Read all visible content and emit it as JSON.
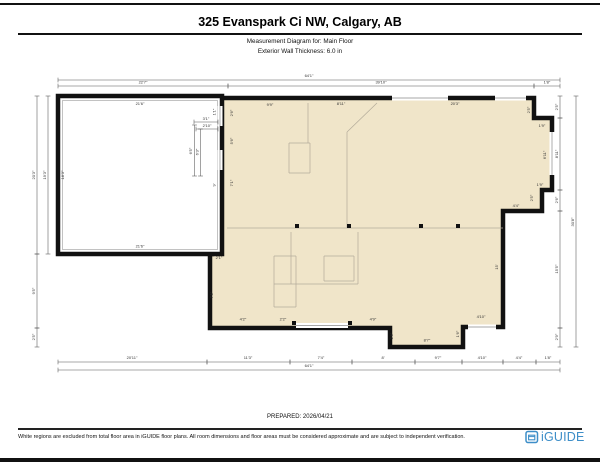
{
  "header": {
    "title": "325 Evanspark Ci NW, Calgary, AB",
    "subtitle1": "Measurement Diagram for: Main Floor",
    "subtitle2": "Exterior Wall Thickness: 6.0 in"
  },
  "footer": {
    "prepared": "PREPARED: 2026/04/21",
    "disclaimer": "White regions are excluded from total floor area in iGUIDE floor plans. All room dimensions and floor areas must be considered approximate and are subject to independent verification.",
    "logo_text": "iGUIDE"
  },
  "colors": {
    "floor_fill": "#f0e5c9",
    "wall": "#111111",
    "dim_line": "#555555",
    "dim_text": "#333333",
    "interior_line": "#b3ab9a",
    "opening_line": "#8a8a8a",
    "logo_blue": "#3d8ec8"
  },
  "floorplan": {
    "main_outline": "212,98 534,98 534,118 552,118 552,190 542,190 542,211 503,211 503,327 463,327 463,347 390,347 390,328 210,328 210,254 212,254",
    "garage": {
      "x": 58,
      "y": 96,
      "w": 164,
      "h": 158
    },
    "garage_inner": {
      "x": 62.5,
      "y": 100.5,
      "w": 155,
      "h": 149
    },
    "dim_lines": [
      [
        58,
        80,
        560,
        80
      ],
      [
        58,
        86,
        228,
        86
      ],
      [
        228,
        86,
        534,
        86
      ],
      [
        534,
        86,
        560,
        86
      ],
      [
        58,
        362,
        207,
        362
      ],
      [
        207,
        362,
        290,
        362
      ],
      [
        290,
        362,
        352,
        362
      ],
      [
        352,
        362,
        415,
        362
      ],
      [
        415,
        362,
        462,
        362
      ],
      [
        462,
        362,
        503,
        362
      ],
      [
        503,
        362,
        536,
        362
      ],
      [
        536,
        362,
        560,
        362
      ],
      [
        58,
        370,
        560,
        370
      ],
      [
        37,
        96,
        37,
        254
      ],
      [
        37,
        254,
        37,
        328
      ],
      [
        37,
        328,
        37,
        347
      ],
      [
        48,
        96,
        48,
        254
      ],
      [
        560,
        96,
        560,
        118
      ],
      [
        560,
        118,
        560,
        190
      ],
      [
        560,
        190,
        560,
        211
      ],
      [
        560,
        211,
        560,
        328
      ],
      [
        560,
        328,
        560,
        347
      ],
      [
        576,
        96,
        576,
        347
      ],
      [
        194,
        122,
        218,
        122
      ],
      [
        196,
        129,
        218,
        129
      ],
      [
        194.5,
        125,
        194.5,
        176
      ],
      [
        200.5,
        129,
        200.5,
        176
      ]
    ],
    "labels": [
      [
        "64'1\"",
        309,
        77,
        0
      ],
      [
        "22'7\"",
        143,
        83.5,
        0
      ],
      [
        "39'10\"",
        381,
        83.5,
        0
      ],
      [
        "1'8\"",
        547,
        83.5,
        0
      ],
      [
        "20'11\"",
        132,
        359,
        0
      ],
      [
        "11'3\"",
        248,
        359,
        0
      ],
      [
        "7'4\"",
        321,
        359,
        0
      ],
      [
        "8'",
        383,
        359,
        0
      ],
      [
        "9'7\"",
        438,
        359,
        0
      ],
      [
        "4'10\"",
        482,
        359,
        0
      ],
      [
        "4'4\"",
        519,
        359,
        0
      ],
      [
        "1'8\"",
        548,
        359,
        0
      ],
      [
        "64'1\"",
        309,
        367,
        0
      ],
      [
        "20'3\"",
        35,
        175,
        1
      ],
      [
        "9'5\"",
        35,
        291,
        1
      ],
      [
        "2'5\"",
        35,
        337,
        1
      ],
      [
        "19'3\"",
        46,
        175,
        1
      ],
      [
        "2'5\"",
        558,
        107,
        1
      ],
      [
        "8'11\"",
        558,
        154,
        1
      ],
      [
        "2'6\"",
        558,
        200,
        1
      ],
      [
        "15'5\"",
        558,
        269,
        1
      ],
      [
        "2'9\"",
        558,
        337,
        1
      ],
      [
        "30'8\"",
        574,
        222,
        1
      ],
      [
        "21'6\"",
        140,
        105,
        0
      ],
      [
        "21'6\"",
        140,
        247.5,
        0
      ],
      [
        "18'3\"",
        64,
        175,
        1
      ],
      [
        "3'1\"",
        206,
        120,
        0
      ],
      [
        "2'10\"",
        207,
        127,
        0
      ],
      [
        "6'5\"",
        192,
        151,
        1
      ],
      [
        "6'3\"",
        198.5,
        152,
        1
      ],
      [
        "1'1\"",
        215.5,
        112,
        1
      ],
      [
        "9'",
        215.5,
        185,
        1
      ],
      [
        "9'9\"",
        270,
        106,
        0
      ],
      [
        "8'11\"",
        341,
        105,
        0
      ],
      [
        "20'3\"",
        455,
        105,
        0
      ],
      [
        "2'5\"",
        530,
        110,
        1
      ],
      [
        "1'9\"",
        542,
        127,
        0
      ],
      [
        "6'11\"",
        546,
        155,
        1
      ],
      [
        "1'9\"",
        540,
        186,
        0
      ],
      [
        "2'5\"",
        533,
        198,
        1
      ],
      [
        "4'4\"",
        516,
        207,
        0
      ],
      [
        "15'",
        498,
        267,
        1
      ],
      [
        "4'10\"",
        481,
        318,
        0
      ],
      [
        "1'6\"",
        459,
        334,
        1
      ],
      [
        "8'7\"",
        427,
        341.5,
        0
      ],
      [
        "2'6\"",
        393,
        336,
        1
      ],
      [
        "4'9\"",
        373,
        320.5,
        0
      ],
      [
        "2'2\"",
        283,
        320.5,
        0
      ],
      [
        "4'2\"",
        243,
        320.5,
        0
      ],
      [
        "2'6\"",
        233,
        113,
        1
      ],
      [
        "5'6\"",
        233,
        141,
        1
      ],
      [
        "7'1\"",
        233,
        183,
        1
      ],
      [
        "2'1\"",
        219,
        259,
        0
      ],
      [
        "7'5\"",
        213,
        295,
        1
      ]
    ],
    "interior_lines": [
      [
        227,
        228,
        503,
        228
      ],
      [
        347,
        132,
        347,
        228
      ],
      [
        347,
        132,
        377,
        103
      ],
      [
        308,
        103,
        308,
        143
      ],
      [
        289,
        143,
        310,
        143
      ],
      [
        289,
        143,
        289,
        173
      ],
      [
        289,
        173,
        310,
        173
      ],
      [
        310,
        143,
        310,
        173
      ],
      [
        291,
        232,
        291,
        284
      ],
      [
        358,
        232,
        358,
        284
      ],
      [
        274,
        284,
        358,
        284
      ],
      [
        274,
        256,
        274,
        307
      ],
      [
        296,
        256,
        296,
        307
      ],
      [
        274,
        256,
        296,
        256
      ],
      [
        274,
        307,
        296,
        307
      ],
      [
        324,
        256,
        354,
        256
      ],
      [
        324,
        281,
        354,
        281
      ],
      [
        324,
        256,
        324,
        281
      ],
      [
        354,
        256,
        354,
        281
      ]
    ],
    "squares": [
      [
        297,
        226
      ],
      [
        349,
        226
      ],
      [
        421,
        226
      ],
      [
        458,
        226
      ],
      [
        294,
        323
      ],
      [
        350,
        323
      ]
    ],
    "openings": [
      [
        296,
        325.5,
        348,
        325.5
      ],
      [
        392,
        98,
        448,
        98
      ],
      [
        495,
        98,
        526,
        98
      ],
      [
        552,
        132,
        552,
        175
      ],
      [
        468,
        327,
        496,
        327
      ],
      [
        220,
        106,
        220,
        126
      ],
      [
        220,
        150,
        220,
        170
      ]
    ]
  }
}
